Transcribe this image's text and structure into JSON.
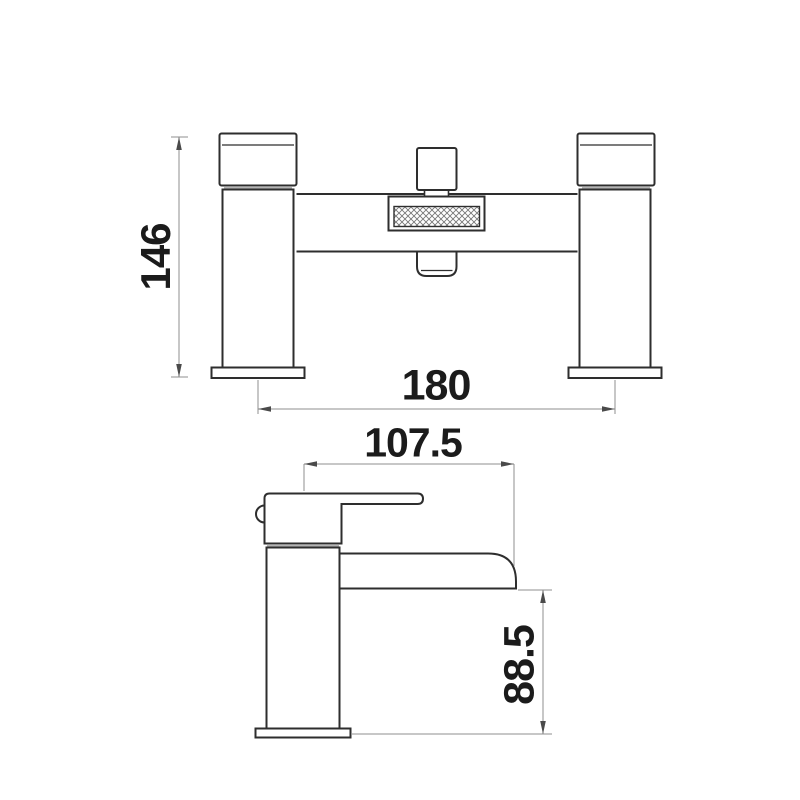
{
  "drawing": {
    "kind": "tap-dimension-technical-drawing",
    "colors": {
      "background": "#ffffff",
      "outline": "#2e2e2e",
      "dimension_line": "#8f8f8f",
      "label_text": "#1b1b1b",
      "joint_band": "#b4b4b4",
      "hatch": "#777777"
    },
    "views": {
      "bath_mixer_front": {
        "name": "bath shower mixer - front view",
        "height_label": "146",
        "width_label": "180"
      },
      "basin_tap_side": {
        "name": "basin waterfall tap - side view",
        "reach_label": "107.5",
        "spout_height_label": "88.5"
      }
    }
  }
}
